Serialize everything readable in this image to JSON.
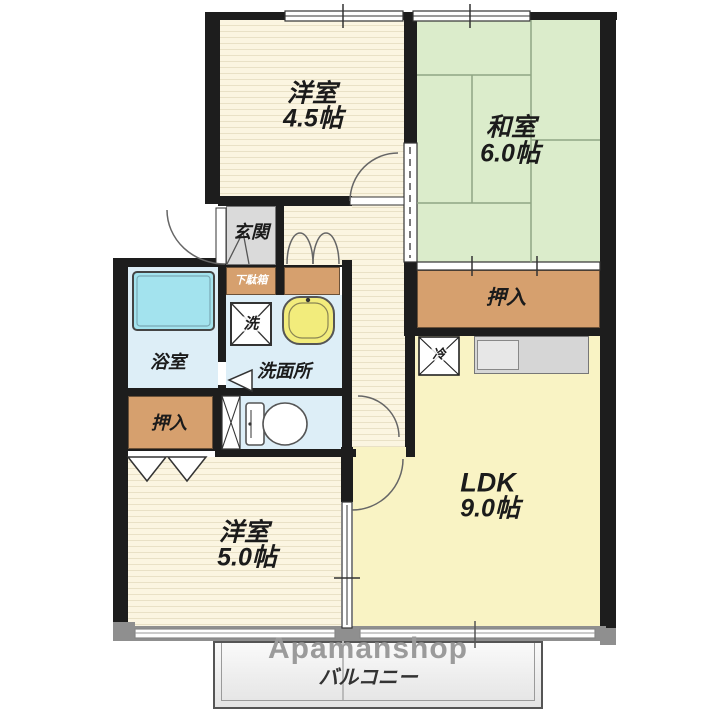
{
  "watermark": {
    "brand": "Apamanshop"
  },
  "rooms": {
    "western_45": {
      "name": "洋室",
      "area": "4.5帖"
    },
    "japanese_6": {
      "name": "和室",
      "area": "6.0帖"
    },
    "ldk": {
      "name": "LDK",
      "area": "9.0帖"
    },
    "western_5": {
      "name": "洋室",
      "area": "5.0帖"
    },
    "balcony": {
      "name": "バルコニー"
    },
    "entrance": {
      "name": "玄関"
    },
    "shoe_cabinet": {
      "name": "下駄箱"
    },
    "washroom": {
      "name": "洗面所"
    },
    "bathroom": {
      "name": "浴室"
    },
    "closet_upper": {
      "name": "押入"
    },
    "closet_lower": {
      "name": "押入"
    },
    "washer_spot": {
      "name": "洗"
    },
    "fridge_spot": {
      "name": "冷"
    }
  },
  "colors": {
    "wall": "#1d1d1d",
    "outer_wall_gray": "#8f8f8f",
    "wood_floor": "#fbf5e1",
    "wood_stripe": "#e9e1c6",
    "tatami": "#dbeccb",
    "tatami_line": "#8fa584",
    "closet_tan": "#d6a06e",
    "entrance_gray": "#dadada",
    "wet_area_blue": "#ddeef7",
    "bathtub_cyan": "#a3e3ee",
    "ldk_yellow": "#f9f3c4",
    "kitchen_counter_gray": "#d6d6d6",
    "sink_yellow": "#f2ec7c",
    "balcony_gray": "#f1f1f1",
    "watermark_gray": "#9b9b9b"
  }
}
